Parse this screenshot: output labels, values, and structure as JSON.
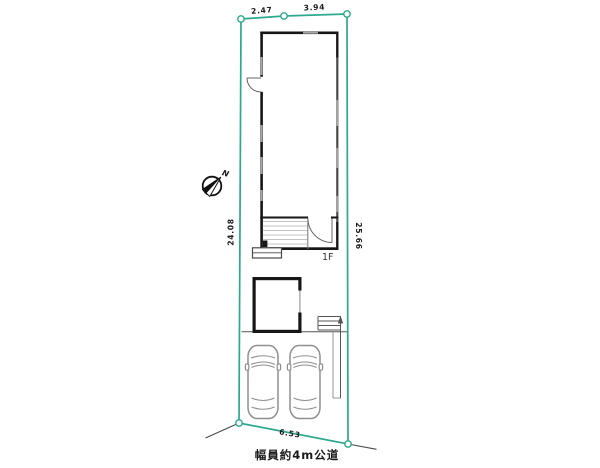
{
  "plan": {
    "dimensions": {
      "top_left": "2.47",
      "top_right": "3.94",
      "left": "24.08",
      "right": "25.66",
      "bottom": "6.53"
    },
    "labels": {
      "road": "幅員約4m公道",
      "floor": "1F",
      "north": "N"
    },
    "colors": {
      "background": "#ffffff",
      "boundary": "#2ba88e",
      "wall": "#161616",
      "window": "#a6a6a6",
      "wall_secondary": "#4a4a4a",
      "thin_line": "#666666",
      "car_outline": "#8f8f8f",
      "text": "#1a1a1a"
    }
  }
}
